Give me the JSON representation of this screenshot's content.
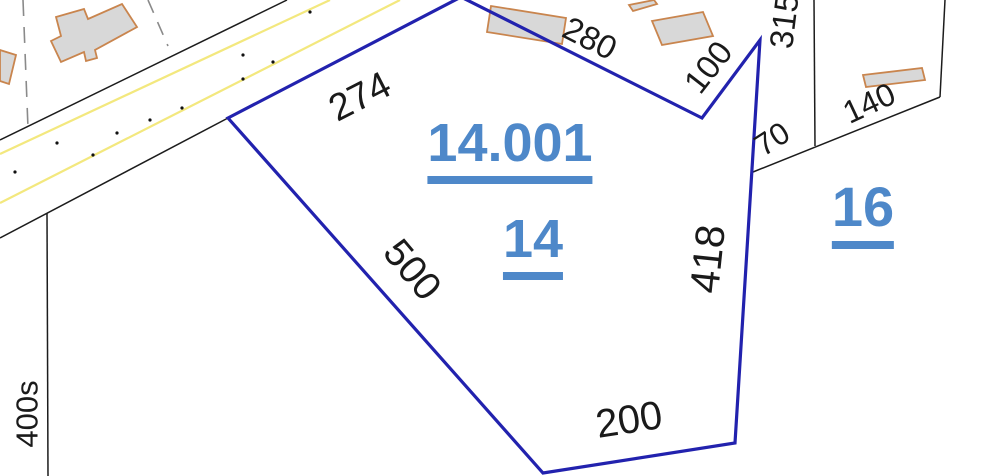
{
  "map_type": "cadastral-parcel-map",
  "parcel_labels": [
    {
      "name": "lot-14001",
      "text": "14.001"
    },
    {
      "name": "lot-14",
      "text": "14"
    },
    {
      "name": "lot-16",
      "text": "16"
    }
  ],
  "dimension_labels": [
    {
      "name": "dim-274",
      "text": "274"
    },
    {
      "name": "dim-280",
      "text": "280"
    },
    {
      "name": "dim-100",
      "text": "100"
    },
    {
      "name": "dim-315",
      "text": "315"
    },
    {
      "name": "dim-140",
      "text": "140"
    },
    {
      "name": "dim-70",
      "text": "70"
    },
    {
      "name": "dim-418",
      "text": "418"
    },
    {
      "name": "dim-500",
      "text": "500"
    },
    {
      "name": "dim-200",
      "text": "200"
    },
    {
      "name": "dim-400s",
      "text": "400s"
    }
  ],
  "colors": {
    "parcel_boundary_blue": "#2222ae",
    "lot_label_blue": "#4e88c9",
    "road_centerline_yellow": "#f3e87e",
    "parcel_line_black": "#1c1c1c",
    "building_fill_gray": "#d8d8d8",
    "building_outline_orange": "#c9854e",
    "dashed_line_gray": "#8a8a8a",
    "background": "#ffffff"
  }
}
